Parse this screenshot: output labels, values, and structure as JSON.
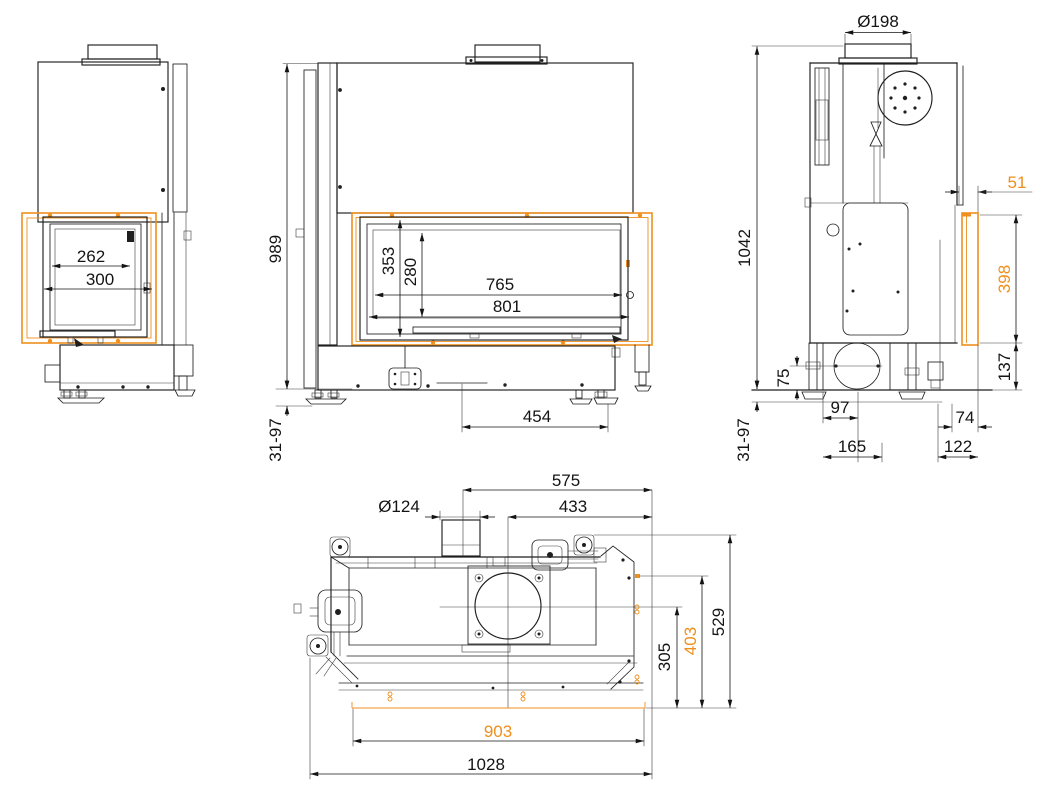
{
  "colors": {
    "line": "#1f1f1f",
    "accent": "#EE8F1E",
    "background": "#ffffff"
  },
  "dims": {
    "side_left": {
      "glass_width": "262",
      "door_width": "300"
    },
    "front": {
      "body_height": "989",
      "opening_height": "353",
      "glass_height": "280",
      "glass_width": "765",
      "door_width": "801",
      "base_span": "454",
      "leveling_range": "31-97"
    },
    "side_right": {
      "flue_diameter": "Ø198",
      "total_height": "1042",
      "frame_depth": "51",
      "frame_height": "398",
      "frame_bottom_height": "137",
      "inlet_center_height": "75",
      "inlet_offset": "97",
      "inlet_span": "165",
      "rear_gap": "74",
      "rear_span": "122",
      "leveling_range": "31-97"
    },
    "top": {
      "flue_center_to_right": "575",
      "flue_diameter": "Ø124",
      "outlet_center_to_right": "433",
      "total_depth": "529",
      "frame_depth": "403",
      "outlet_to_front": "305",
      "frame_width": "903",
      "total_width": "1028"
    }
  }
}
